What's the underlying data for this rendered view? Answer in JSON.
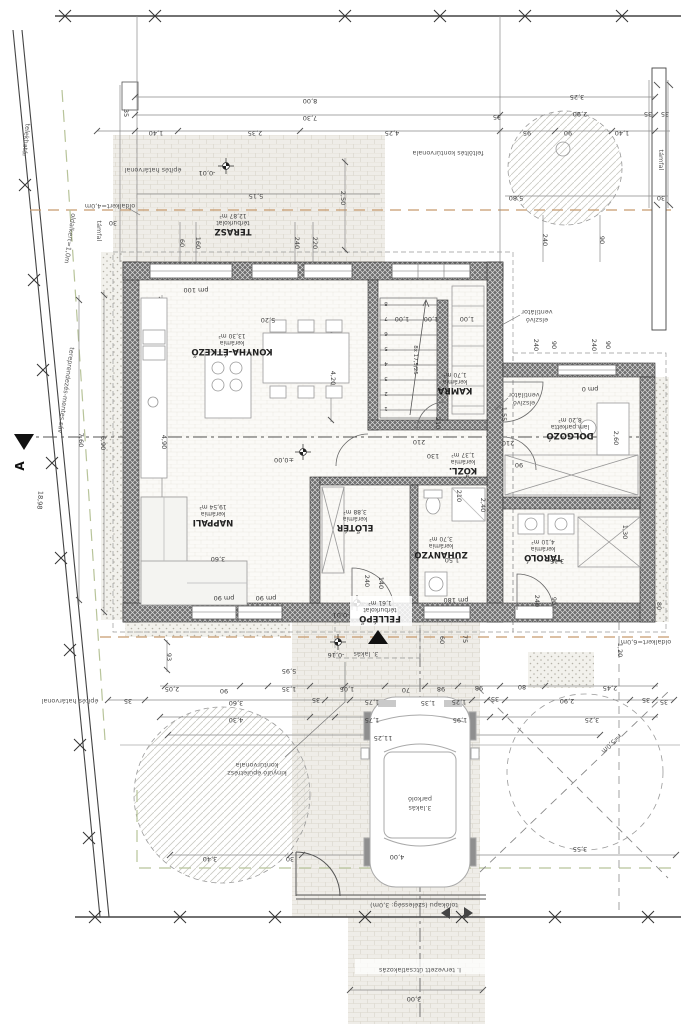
{
  "rooms": [
    {
      "name": "TERASZ",
      "material": "térburkolat",
      "area": "12,87 m²"
    },
    {
      "name": "KONYHA-ÉTKEZŐ",
      "material": "kerámia",
      "area": "13,30 m²"
    },
    {
      "name": "NAPPALI",
      "material": "kerámia",
      "area": "19,54 m²"
    },
    {
      "name": "KAMRA",
      "material": "kerámia",
      "area": "1,70 m²"
    },
    {
      "name": "KÖZL.",
      "material": "kerámia",
      "area": "1,37 m²"
    },
    {
      "name": "ELŐTÉR",
      "material": "kerámia",
      "area": "3,88 m²"
    },
    {
      "name": "ZUHANYZÓ",
      "material": "kerámia",
      "area": "3,70 m²"
    },
    {
      "name": "DOLGOZÓ",
      "material": "lam.parketta",
      "area": "8,20 m²"
    },
    {
      "name": "TÁROLÓ",
      "material": "kerámia",
      "area": "4,10 m²"
    },
    {
      "name": "FELLÉPŐ",
      "material": "térburkolat",
      "area": "1,61 m²"
    }
  ],
  "annotations": {
    "telekhatar": "telekhatár",
    "epites_hatarvonal": "építés határvonal",
    "oldalkert_4": "oldalkert=4,0m",
    "oldalkert_1": "oldalkert=1,0m",
    "oldalkert_6": "oldalkert=6,0m",
    "tereprendezes": "tereprendezés-mentes sáv",
    "tamfal": "támfal",
    "feltoltes": "feltöltés kontúrvonala",
    "elszivo_1": "elszívó",
    "elszivo_2": "ventilátor",
    "kinyulo_1": "kinyúló épületrész",
    "kinyulo_2": "kontúrvonala",
    "lakas_jel": "3. lakás",
    "parkolo_1": "3.lakás",
    "parkolo_2": "parkoló",
    "tolokapu": "tolókapu (szélesség: 3,0m)",
    "utcsatlakozas": "I. tervezett útcsatlakozás",
    "section_mark": "A",
    "radius": "r=5,0m",
    "stair_text": "8x 17,5/25"
  },
  "elevations": {
    "terasz": "-0,01",
    "belso": "±0,00",
    "fellepo": "-0,01",
    "terep": "-0,16"
  },
  "stairs": [
    "1",
    "2",
    "3",
    "4",
    "5",
    "6",
    "7",
    "8"
  ],
  "dims": [
    "8,00",
    "7,30",
    "1,40",
    "2,35",
    "4,25",
    "95",
    "90",
    "1,40",
    "3,25",
    "2,90",
    "35",
    "35",
    "35",
    "35",
    "5,80",
    "30",
    "5,15",
    "30",
    "2,50",
    "60",
    "160",
    "240",
    "220",
    "pm 100",
    "240",
    "90",
    "5,20",
    "1,00",
    "1,00",
    "1,00",
    "240",
    "90",
    "240",
    "90",
    "pm 0",
    "7,60",
    "6,90",
    "4,90",
    "4,20",
    "1,55",
    "210",
    "210",
    "130",
    "210",
    "90",
    "2,60",
    "3,60",
    "2,40",
    "210",
    "1,50",
    "3,15",
    "1,30",
    "pm 90",
    "pm 90",
    "pm 180",
    "240",
    "140",
    "240",
    "90",
    "80",
    "1,20",
    "60",
    "75",
    "5,95",
    "93",
    "2,05",
    "90",
    "1,35",
    "1,05",
    "70",
    "98",
    "98",
    "80",
    "2,45",
    "35",
    "3,60",
    "35",
    "1,75",
    "1,35",
    "1,25",
    "35",
    "2,90",
    "35",
    "35",
    "4,30",
    "1,75",
    "1,95",
    "3,25",
    "11,25",
    "3,40",
    "30",
    "4,00",
    "3,55",
    "3,00",
    "18,98"
  ]
}
